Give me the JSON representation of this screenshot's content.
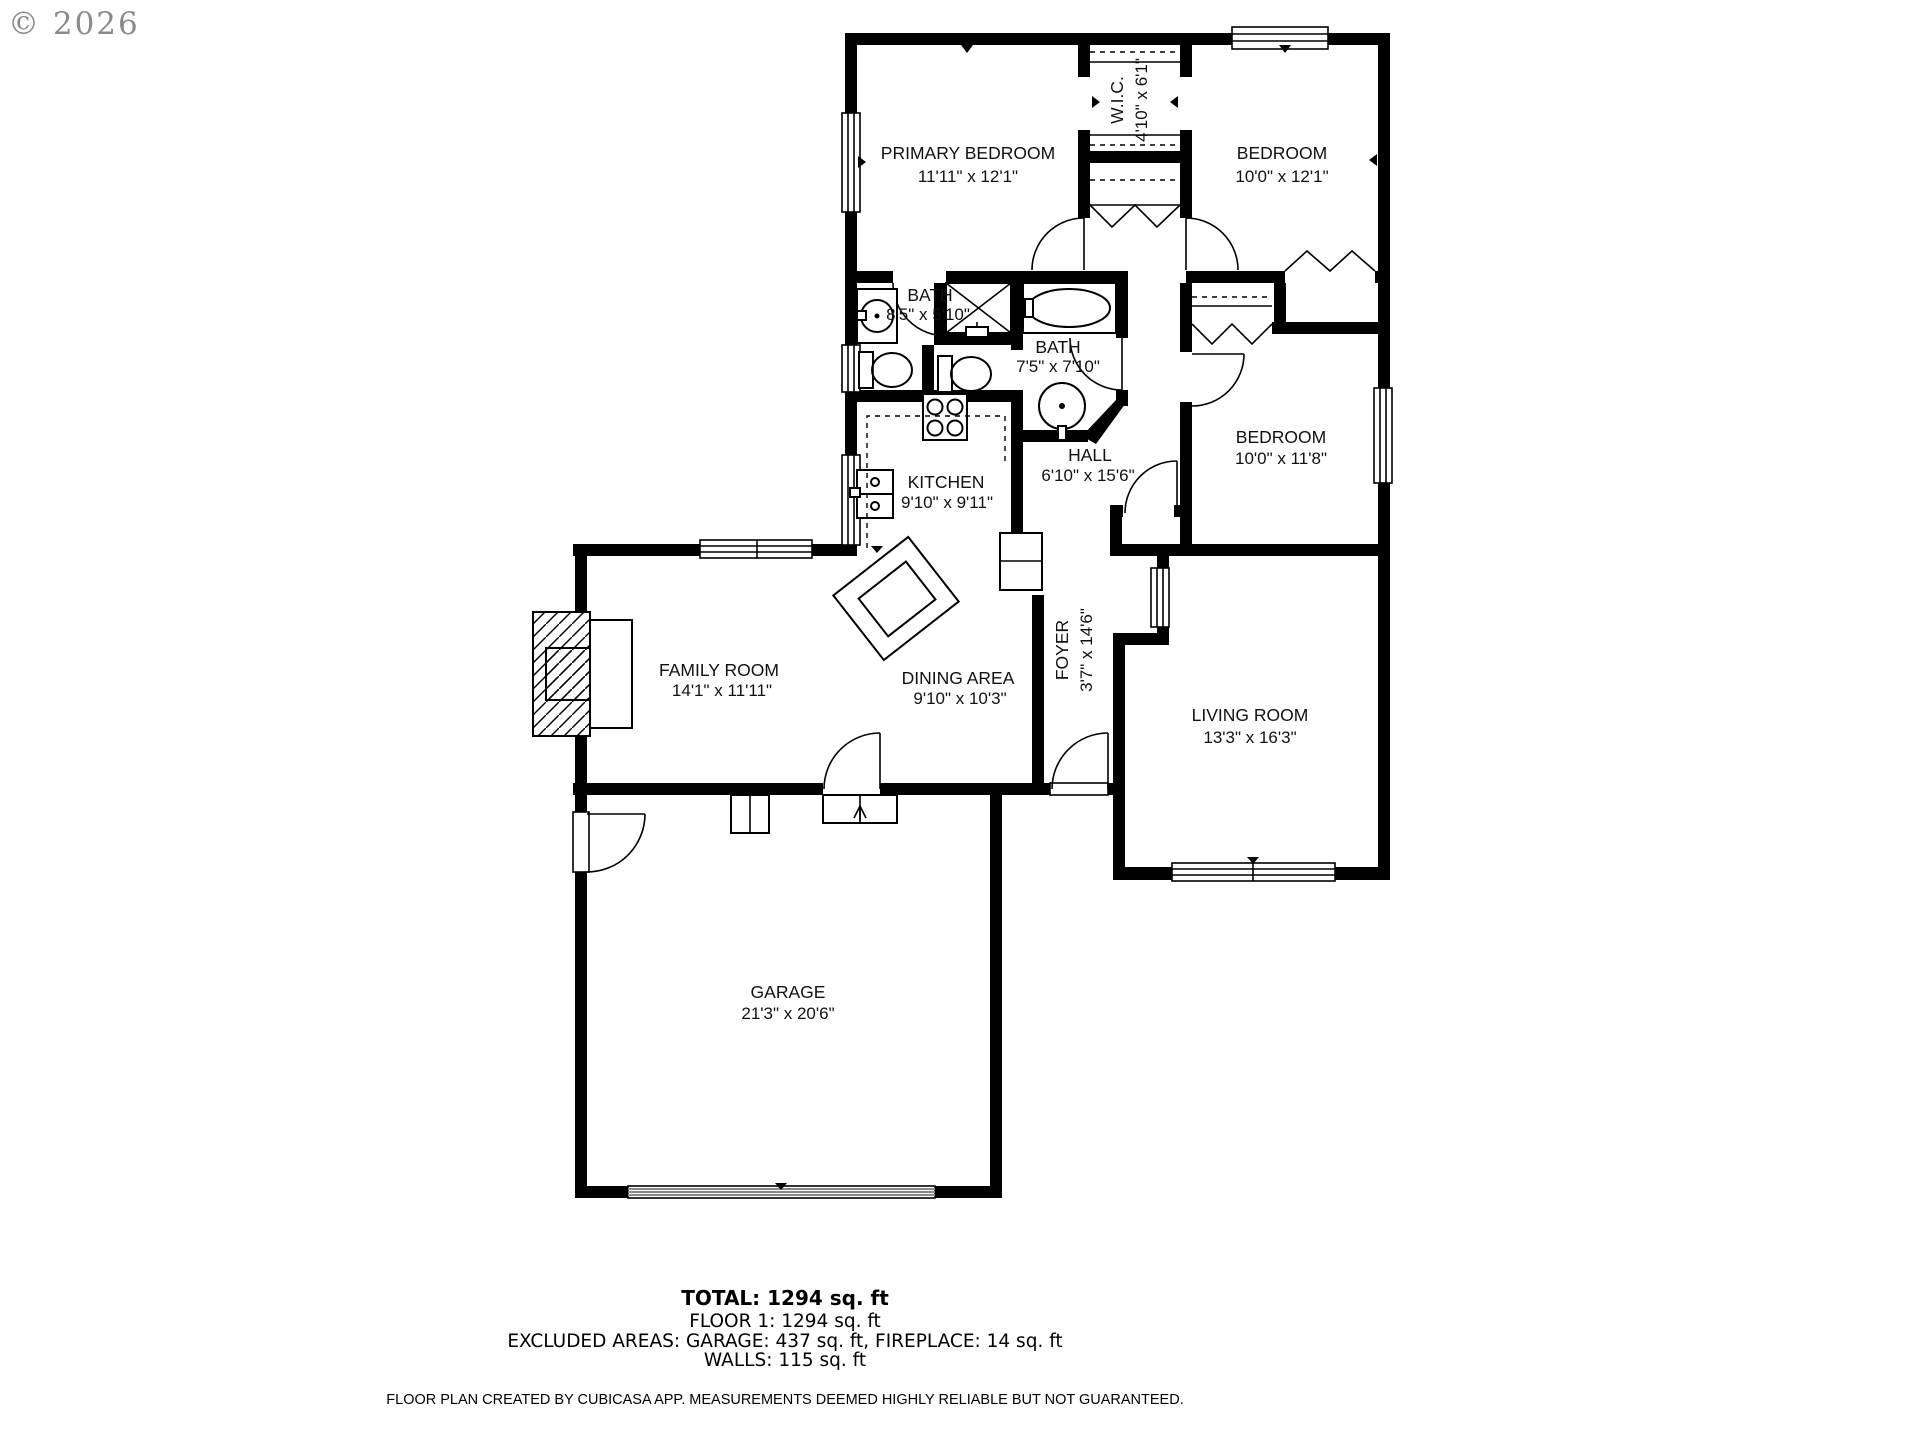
{
  "watermark": "© 2026",
  "rooms": {
    "primary_bedroom": {
      "name": "PRIMARY BEDROOM",
      "dims": "11'11\" x 12'1\""
    },
    "wic": {
      "name": "W.I.C.",
      "dims": "4'10\" x 6'1\""
    },
    "bedroom1": {
      "name": "BEDROOM",
      "dims": "10'0\" x 12'1\""
    },
    "bath1": {
      "name": "BATH",
      "dims": "8'5\" x 5'10\""
    },
    "bath2": {
      "name": "BATH",
      "dims": "7'5\" x 7'10\""
    },
    "bedroom2": {
      "name": "BEDROOM",
      "dims": "10'0\" x 11'8\""
    },
    "hall": {
      "name": "HALL",
      "dims": "6'10\" x 15'6\""
    },
    "kitchen": {
      "name": "KITCHEN",
      "dims": "9'10\" x 9'11\""
    },
    "family_room": {
      "name": "FAMILY ROOM",
      "dims": "14'1\" x 11'11\""
    },
    "dining_area": {
      "name": "DINING AREA",
      "dims": "9'10\" x 10'3\""
    },
    "foyer": {
      "name": "FOYER",
      "dims": "3'7\" x 14'6\""
    },
    "living_room": {
      "name": "LIVING ROOM",
      "dims": "13'3\" x 16'3\""
    },
    "garage": {
      "name": "GARAGE",
      "dims": "21'3\" x 20'6\""
    }
  },
  "summary": {
    "total": "TOTAL: 1294 sq. ft",
    "floor1": "FLOOR 1: 1294 sq. ft",
    "excluded": "EXCLUDED AREAS: GARAGE: 437 sq. ft, FIREPLACE: 14 sq. ft",
    "walls": "WALLS: 115 sq. ft"
  },
  "disclaimer": "FLOOR PLAN CREATED BY CUBICASA APP. MEASUREMENTS DEEMED HIGHLY RELIABLE BUT NOT GUARANTEED.",
  "colors": {
    "wall": "#000000",
    "background": "#ffffff",
    "watermark": "#8a8a8a",
    "garage_door": "#8a8a8a"
  }
}
